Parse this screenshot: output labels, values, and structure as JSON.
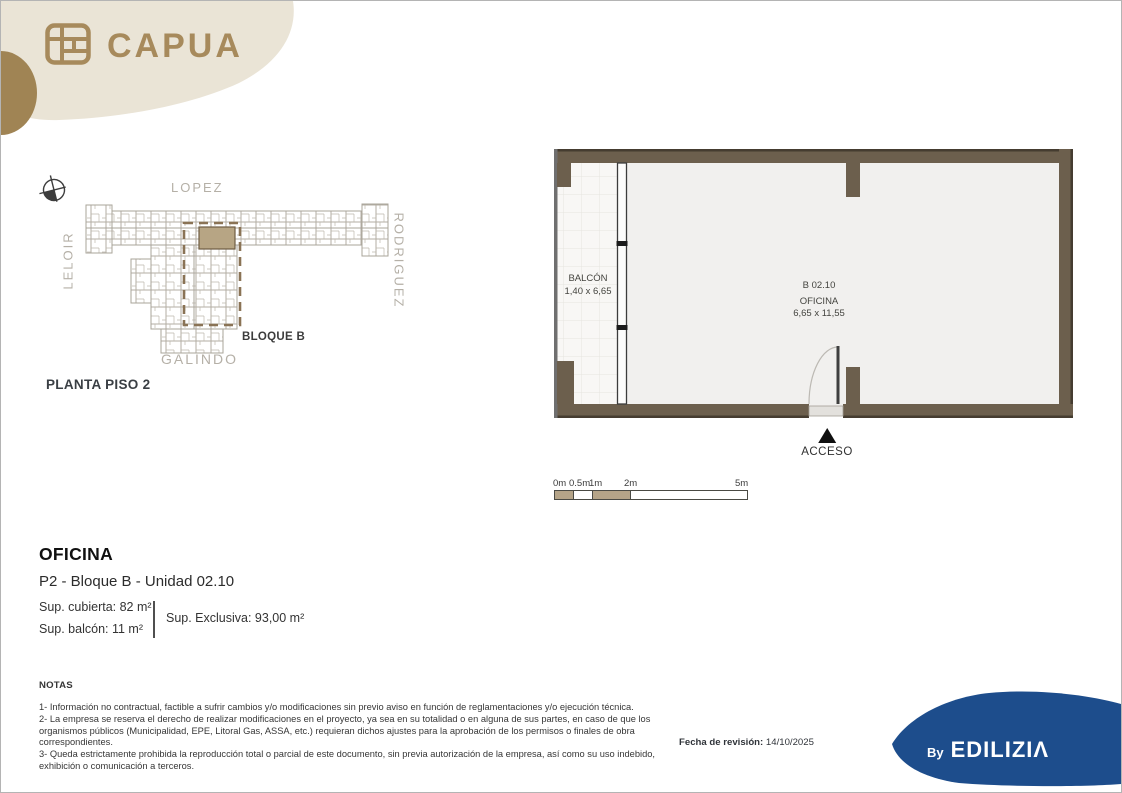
{
  "brand": {
    "name": "CAPUA",
    "by_label": "By",
    "developer": "EDILIZIΛ",
    "accent_tan": "#a78a5c",
    "blob_beige": "#eae4d6",
    "blob_tan": "#a08454",
    "blob_blue": "#1d4d8c"
  },
  "site_map": {
    "title": "PLANTA PISO 2",
    "streets": {
      "top": "LOPEZ",
      "left": "LELOIR",
      "right": "RODRIGUEZ",
      "bottom": "GALINDO"
    },
    "block_label": "BLOQUE B"
  },
  "floor_plan": {
    "balcony": {
      "line1": "BALCÓN",
      "line2": "1,40 x 6,65"
    },
    "room": {
      "line1": "B 02.10",
      "line2": "OFICINA",
      "line3": "6,65 x 11,55"
    },
    "access_label": "ACCESO"
  },
  "scale_bar": {
    "labels": [
      "0m",
      "0.5m",
      "1m",
      "2m",
      "5m"
    ]
  },
  "unit_info": {
    "title": "OFICINA",
    "subtitle": "P2 - Bloque B - Unidad 02.10",
    "sup_cubierta": "Sup. cubierta: 82 m²",
    "sup_balcon": "Sup. balcón: 11 m²",
    "sup_exclusiva": "Sup. Exclusiva: 93,00 m²"
  },
  "notes": {
    "title": "NOTAS",
    "items": [
      "1- Información no contractual, factible a sufrir cambios y/o modificaciones sin previo aviso en función de reglamentaciones y/o ejecución técnica.",
      "2- La empresa se reserva el derecho de realizar modificaciones en el proyecto, ya sea en su totalidad o en alguna de sus partes, en caso de que los organismos públicos (Municipalidad, EPE, Litoral Gas, ASSA, etc.) requieran dichos ajustes para la aprobación de los permisos o finales de obra correspondientes.",
      "3- Queda estrictamente prohibida la reproducción total o parcial de este documento, sin previa autorización de la empresa, así como su uso indebido, exhibición o comunicación a terceros."
    ]
  },
  "revision": {
    "label": "Fecha de revisión:",
    "date": "14/10/2025"
  }
}
